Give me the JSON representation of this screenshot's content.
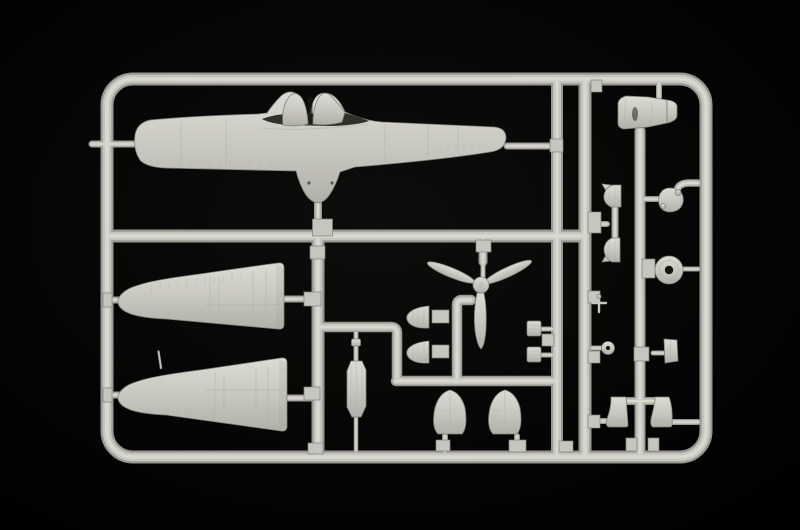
{
  "scene": {
    "type": "photograph",
    "subject": "injection-molded plastic model kit sprue with small-scale aircraft parts on black background",
    "colors": {
      "bg-center": "#0d0d0b",
      "bg-mid": "#040404",
      "bg-edge": "#000000",
      "plastic-light": "#dddcd4",
      "plastic-base": "#c7c6be",
      "plastic-mid": "#b1b0a8",
      "plastic-dark": "#9a9991",
      "plastic-edge": "#82817a",
      "hole-dark": "#151511"
    },
    "parts": [
      {
        "id": "sprue-frame",
        "label": "rounded rectangular sprue frame with internal runners"
      },
      {
        "id": "fuselage-half",
        "label": "fuselage half with cockpit opening and twin headrest fairings, lying horizontally"
      },
      {
        "id": "wing-panel-upper",
        "label": "tapered wing half, tip at left"
      },
      {
        "id": "wing-panel-lower",
        "label": "tapered wing half with pitot spike, tip at left"
      },
      {
        "id": "propeller",
        "label": "three-blade propeller with spinner pointing down"
      },
      {
        "id": "engine-cowling",
        "label": "engine cowling lying on its side"
      },
      {
        "id": "fairing-fan-a",
        "label": "small fan-shaped fairing"
      },
      {
        "id": "fairing-fan-b",
        "label": "small fan-shaped fairing"
      },
      {
        "id": "ribbed-block-a",
        "label": "small ribbed block part"
      },
      {
        "id": "ribbed-block-b",
        "label": "small ribbed block part"
      },
      {
        "id": "gear-strut",
        "label": "landing-gear strut / cylindrical part"
      },
      {
        "id": "dome-fairing-a",
        "label": "dome shaped wheel-spat half with ribs"
      },
      {
        "id": "dome-fairing-b",
        "label": "dome shaped wheel-spat half with ribs"
      },
      {
        "id": "round-blob-part",
        "label": "small rounded lump part on curved gate"
      },
      {
        "id": "exhaust-wedge-a",
        "label": "small wedge part with fin"
      },
      {
        "id": "exhaust-wedge-b",
        "label": "small wedge part with fin"
      },
      {
        "id": "main-wheel",
        "label": "main wheel disc with hub hole"
      },
      {
        "id": "tail-wheel",
        "label": "small tail wheel"
      },
      {
        "id": "pitot-t-part",
        "label": "tiny T-shaped probe part"
      },
      {
        "id": "flat-panel",
        "label": "small flat rectangular panel"
      },
      {
        "id": "gear-cover-a",
        "label": "boot-shaped gear cover"
      },
      {
        "id": "gear-cover-b",
        "label": "boot-shaped gear cover"
      }
    ]
  }
}
